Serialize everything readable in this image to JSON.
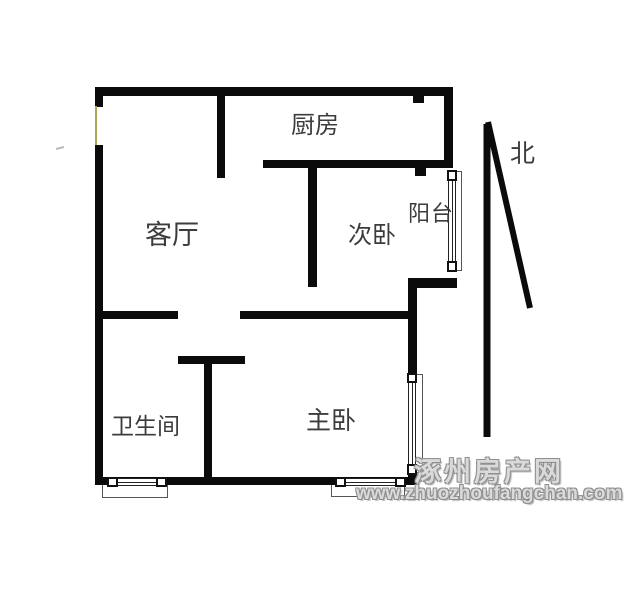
{
  "title": "apartment-floor-plan",
  "labels": {
    "kitchen": "厨房",
    "living_room": "客厅",
    "bedroom2": "次卧",
    "balcony": "阳台",
    "bathroom": "卫生间",
    "master_bedroom": "主卧",
    "north": "北"
  },
  "watermark": {
    "site_name": "涿州房产网",
    "site_url": "www.zhuozhoufangchan.com"
  },
  "colors": {
    "wall": "#0b0b0b",
    "label_text": "#3c3c3c",
    "entry_door_line": "#a8a858",
    "watermark_fill": "#dadada",
    "watermark_outline": "#8f8f8f",
    "background": "#ffffff"
  }
}
